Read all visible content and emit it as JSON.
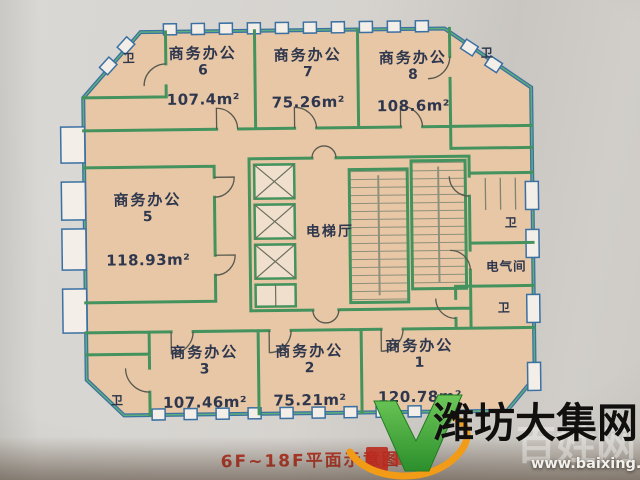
{
  "plan": {
    "caption": "6F~18F平面示意图",
    "labels": {
      "elevator_hall": "电梯厅",
      "electrical_room": "电气间",
      "toilet": "卫"
    },
    "rooms": [
      {
        "name": "商务办公",
        "number": "6",
        "area": "107.4m²"
      },
      {
        "name": "商务办公",
        "number": "7",
        "area": "75.26m²"
      },
      {
        "name": "商务办公",
        "number": "8",
        "area": "108.6m²"
      },
      {
        "name": "商务办公",
        "number": "5",
        "area": "118.93m²"
      },
      {
        "name": "商务办公",
        "number": "3",
        "area": "107.46m²"
      },
      {
        "name": "商务办公",
        "number": "2",
        "area": "75.21m²"
      },
      {
        "name": "商务办公",
        "number": "1",
        "area": "120.78m²"
      }
    ]
  },
  "watermark": {
    "site_name": "潍坊大集网",
    "overlay_name": "百姓网",
    "url": "www.baixing.com"
  },
  "colors": {
    "room_fill": "#e8c7a6",
    "wall_green": "#44935e",
    "wall_blue": "#3a70a2",
    "caption_red": "#bf3a2b",
    "label_ink": "#2e374d",
    "logo_green": "#3ca43a",
    "logo_orange": "#f29b16"
  }
}
